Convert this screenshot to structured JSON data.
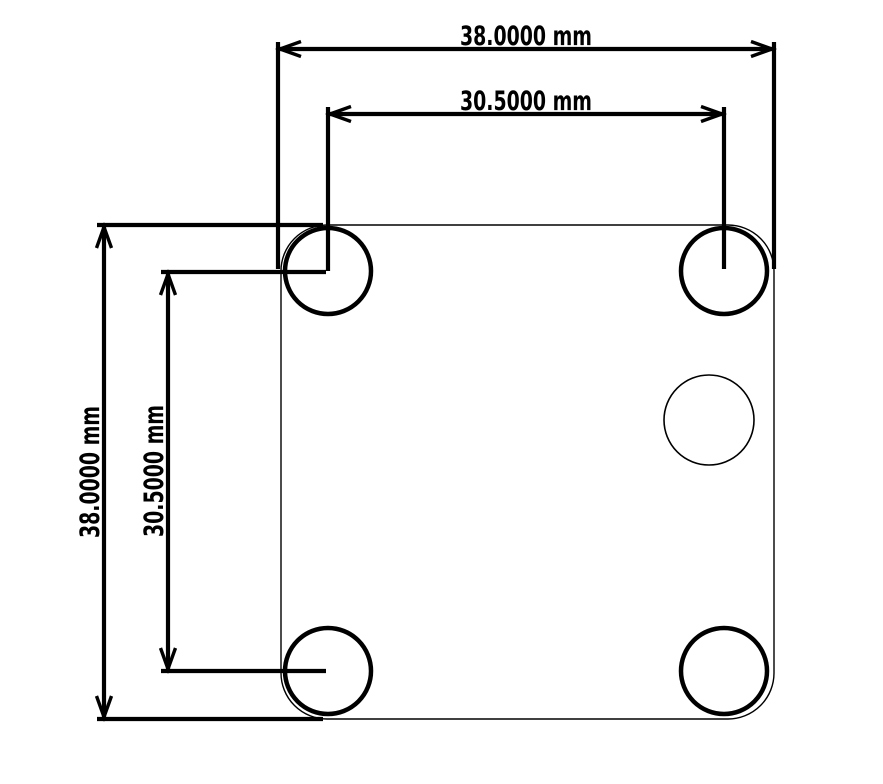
{
  "drawing": {
    "type": "mechanical-part-drawing",
    "part": "square mounting plate with four corner holes and one center hole",
    "background_color": "#ffffff",
    "line_color": "#000000",
    "units": "mm",
    "dimensions": [
      {
        "id": "overall-width",
        "axis": "horizontal",
        "value": "38.0000",
        "unit": "mm",
        "label": "38.0000 mm"
      },
      {
        "id": "hole-spacing-width",
        "axis": "horizontal",
        "value": "30.5000",
        "unit": "mm",
        "label": "30.5000 mm"
      },
      {
        "id": "overall-height",
        "axis": "vertical",
        "value": "38.0000",
        "unit": "mm",
        "label": "38.0000 mm"
      },
      {
        "id": "hole-spacing-height",
        "axis": "vertical",
        "value": "30.5000",
        "unit": "mm",
        "label": "30.5000 mm"
      }
    ]
  }
}
